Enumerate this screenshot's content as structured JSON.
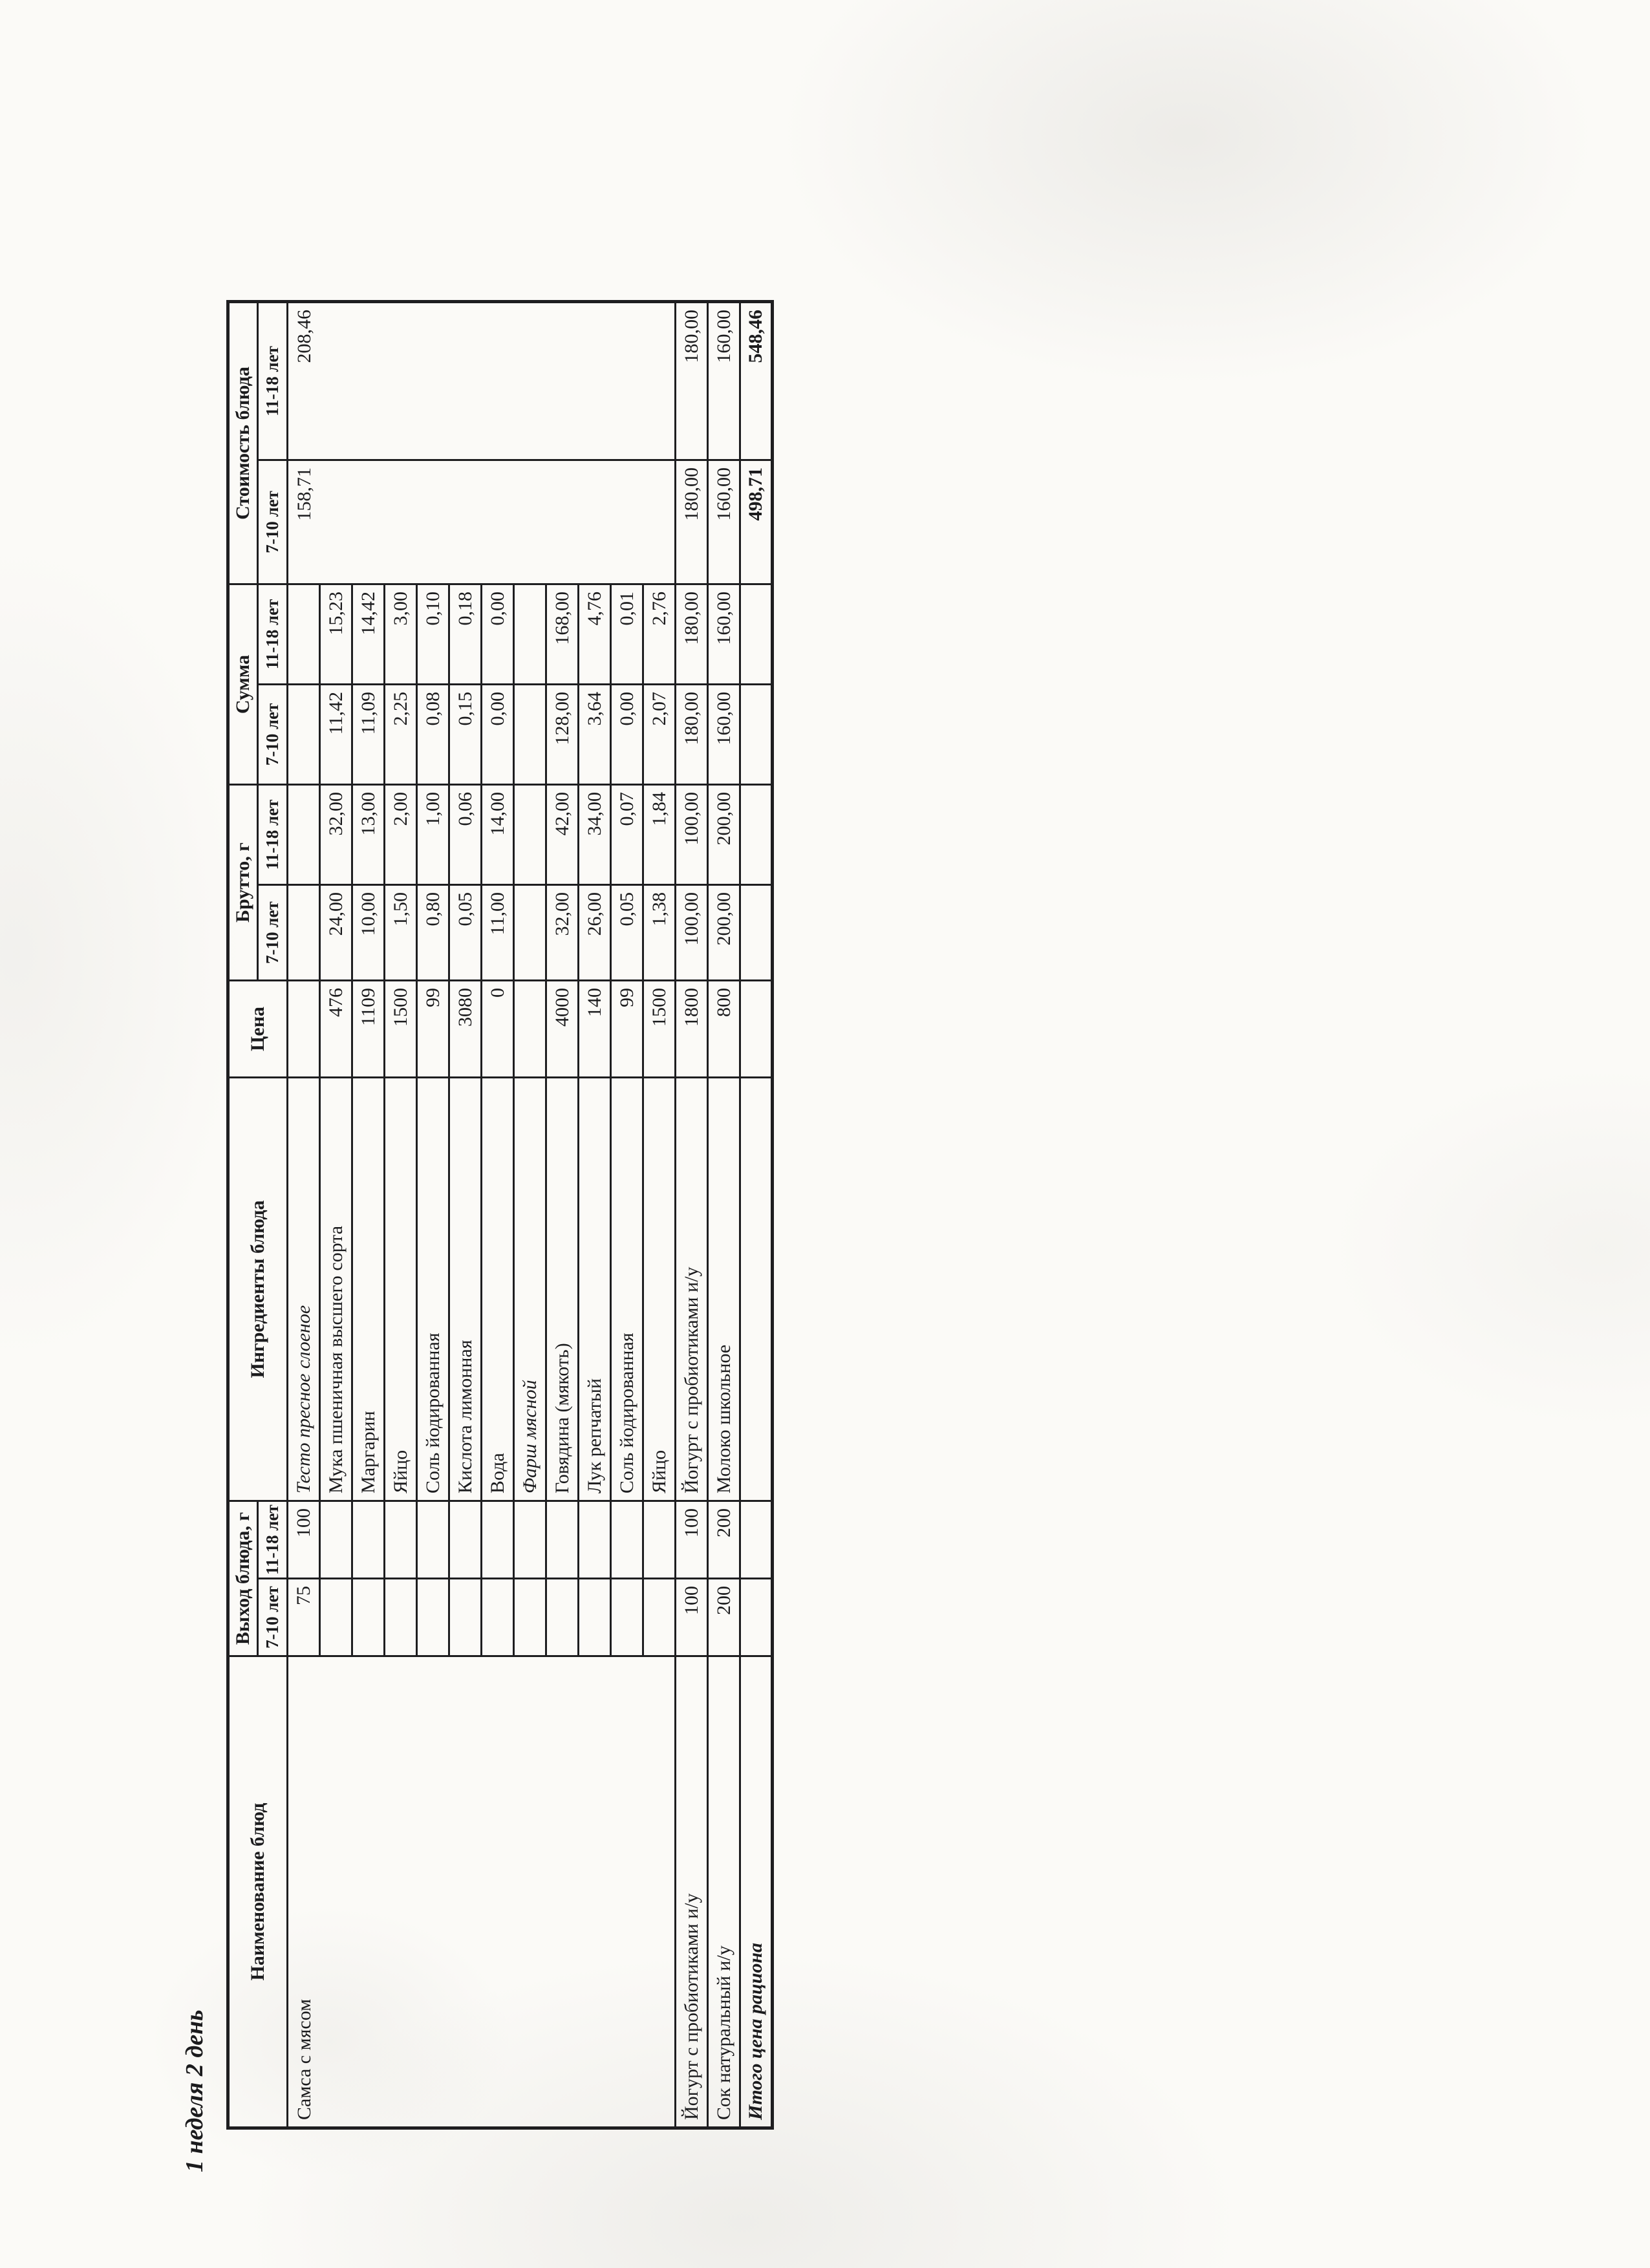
{
  "document": {
    "title": "1 неделя 2 день",
    "paper_color": "#fbfaf7",
    "ink_color": "#1b1b1d"
  },
  "table": {
    "column_headers": {
      "name": "Наименование блюд",
      "yield": "Выход блюда, г",
      "ingredients": "Ингредиенты блюда",
      "price": "Цена",
      "gross": "Брутто, г",
      "sum": "Сумма",
      "cost": "Стоимость блюда",
      "age_7_10": "7-10 лет",
      "age_11_18": "11-18 лет"
    },
    "body": [
      {
        "cells": [
          {
            "v": "Самса с мясом",
            "cls": "txt vtop",
            "rs": 12,
            "n": "dish-name-cell"
          },
          {
            "v": "75",
            "cls": "num"
          },
          {
            "v": "100",
            "cls": "num"
          },
          {
            "v": "Тесто пресное слоеное",
            "cls": "txt italic",
            "n": "ingredient-group-cell"
          },
          {
            "v": ""
          },
          {
            "v": ""
          },
          {
            "v": ""
          },
          {
            "v": ""
          },
          {
            "v": ""
          },
          {
            "v": "158,71",
            "cls": "num vtop",
            "rs": 12,
            "n": "dish-cost-cell"
          },
          {
            "v": "208,46",
            "cls": "num vtop",
            "rs": 12,
            "n": "dish-cost-cell"
          }
        ]
      },
      {
        "cells": [
          {
            "v": ""
          },
          {
            "v": ""
          },
          {
            "v": "Мука пшеничная высшего\nсорта",
            "cls": "txt",
            "n": "ingredient-cell"
          },
          {
            "v": "476",
            "cls": "num"
          },
          {
            "v": "24,00",
            "cls": "num"
          },
          {
            "v": "32,00",
            "cls": "num"
          },
          {
            "v": "11,42",
            "cls": "num"
          },
          {
            "v": "15,23",
            "cls": "num"
          }
        ]
      },
      {
        "cells": [
          {
            "v": ""
          },
          {
            "v": ""
          },
          {
            "v": "Маргарин",
            "cls": "txt",
            "n": "ingredient-cell"
          },
          {
            "v": "1109",
            "cls": "num"
          },
          {
            "v": "10,00",
            "cls": "num"
          },
          {
            "v": "13,00",
            "cls": "num"
          },
          {
            "v": "11,09",
            "cls": "num"
          },
          {
            "v": "14,42",
            "cls": "num"
          }
        ]
      },
      {
        "cells": [
          {
            "v": ""
          },
          {
            "v": ""
          },
          {
            "v": "Яйцо",
            "cls": "txt",
            "n": "ingredient-cell"
          },
          {
            "v": "1500",
            "cls": "num"
          },
          {
            "v": "1,50",
            "cls": "num"
          },
          {
            "v": "2,00",
            "cls": "num"
          },
          {
            "v": "2,25",
            "cls": "num"
          },
          {
            "v": "3,00",
            "cls": "num"
          }
        ]
      },
      {
        "cells": [
          {
            "v": ""
          },
          {
            "v": ""
          },
          {
            "v": "Соль йодированная",
            "cls": "txt",
            "n": "ingredient-cell"
          },
          {
            "v": "99",
            "cls": "num"
          },
          {
            "v": "0,80",
            "cls": "num"
          },
          {
            "v": "1,00",
            "cls": "num"
          },
          {
            "v": "0,08",
            "cls": "num"
          },
          {
            "v": "0,10",
            "cls": "num"
          }
        ]
      },
      {
        "cells": [
          {
            "v": ""
          },
          {
            "v": ""
          },
          {
            "v": "Кислота лимонная",
            "cls": "txt",
            "n": "ingredient-cell"
          },
          {
            "v": "3080",
            "cls": "num"
          },
          {
            "v": "0,05",
            "cls": "num"
          },
          {
            "v": "0,06",
            "cls": "num"
          },
          {
            "v": "0,15",
            "cls": "num"
          },
          {
            "v": "0,18",
            "cls": "num"
          }
        ]
      },
      {
        "cells": [
          {
            "v": ""
          },
          {
            "v": ""
          },
          {
            "v": "Вода",
            "cls": "txt",
            "n": "ingredient-cell"
          },
          {
            "v": "0",
            "cls": "num"
          },
          {
            "v": "11,00",
            "cls": "num"
          },
          {
            "v": "14,00",
            "cls": "num"
          },
          {
            "v": "0,00",
            "cls": "num"
          },
          {
            "v": "0,00",
            "cls": "num"
          }
        ]
      },
      {
        "cells": [
          {
            "v": ""
          },
          {
            "v": ""
          },
          {
            "v": "Фарш мясной",
            "cls": "txt italic",
            "n": "ingredient-group-cell"
          },
          {
            "v": ""
          },
          {
            "v": ""
          },
          {
            "v": ""
          },
          {
            "v": ""
          },
          {
            "v": ""
          }
        ]
      },
      {
        "cells": [
          {
            "v": ""
          },
          {
            "v": ""
          },
          {
            "v": "Говядина (мякоть)",
            "cls": "txt",
            "n": "ingredient-cell"
          },
          {
            "v": "4000",
            "cls": "num"
          },
          {
            "v": "32,00",
            "cls": "num"
          },
          {
            "v": "42,00",
            "cls": "num"
          },
          {
            "v": "128,00",
            "cls": "num"
          },
          {
            "v": "168,00",
            "cls": "num"
          }
        ]
      },
      {
        "cells": [
          {
            "v": ""
          },
          {
            "v": ""
          },
          {
            "v": "Лук репчатый",
            "cls": "txt",
            "n": "ingredient-cell"
          },
          {
            "v": "140",
            "cls": "num"
          },
          {
            "v": "26,00",
            "cls": "num"
          },
          {
            "v": "34,00",
            "cls": "num"
          },
          {
            "v": "3,64",
            "cls": "num"
          },
          {
            "v": "4,76",
            "cls": "num"
          }
        ]
      },
      {
        "cells": [
          {
            "v": ""
          },
          {
            "v": ""
          },
          {
            "v": "Соль йодированная",
            "cls": "txt",
            "n": "ingredient-cell"
          },
          {
            "v": "99",
            "cls": "num"
          },
          {
            "v": "0,05",
            "cls": "num"
          },
          {
            "v": "0,07",
            "cls": "num"
          },
          {
            "v": "0,00",
            "cls": "num"
          },
          {
            "v": "0,01",
            "cls": "num"
          }
        ]
      },
      {
        "cells": [
          {
            "v": ""
          },
          {
            "v": ""
          },
          {
            "v": "Яйцо",
            "cls": "txt",
            "n": "ingredient-cell"
          },
          {
            "v": "1500",
            "cls": "num"
          },
          {
            "v": "1,38",
            "cls": "num"
          },
          {
            "v": "1,84",
            "cls": "num"
          },
          {
            "v": "2,07",
            "cls": "num"
          },
          {
            "v": "2,76",
            "cls": "num"
          }
        ]
      },
      {
        "cells": [
          {
            "v": "Йогурт с пробиотиками и/у",
            "cls": "txt",
            "n": "dish-name-cell"
          },
          {
            "v": "100",
            "cls": "num"
          },
          {
            "v": "100",
            "cls": "num"
          },
          {
            "v": "Йогурт с пробиотиками и/у",
            "cls": "txt",
            "n": "ingredient-cell"
          },
          {
            "v": "1800",
            "cls": "num"
          },
          {
            "v": "100,00",
            "cls": "num"
          },
          {
            "v": "100,00",
            "cls": "num"
          },
          {
            "v": "180,00",
            "cls": "num"
          },
          {
            "v": "180,00",
            "cls": "num"
          },
          {
            "v": "180,00",
            "cls": "num",
            "n": "dish-cost-cell"
          },
          {
            "v": "180,00",
            "cls": "num",
            "n": "dish-cost-cell"
          }
        ]
      },
      {
        "cells": [
          {
            "v": "Сок натуральный и/у",
            "cls": "txt",
            "n": "dish-name-cell"
          },
          {
            "v": "200",
            "cls": "num"
          },
          {
            "v": "200",
            "cls": "num"
          },
          {
            "v": "Молоко школьное",
            "cls": "txt",
            "n": "ingredient-cell"
          },
          {
            "v": "800",
            "cls": "num"
          },
          {
            "v": "200,00",
            "cls": "num"
          },
          {
            "v": "200,00",
            "cls": "num"
          },
          {
            "v": "160,00",
            "cls": "num"
          },
          {
            "v": "160,00",
            "cls": "num"
          },
          {
            "v": "160,00",
            "cls": "num",
            "n": "dish-cost-cell"
          },
          {
            "v": "160,00",
            "cls": "num",
            "n": "dish-cost-cell"
          }
        ]
      },
      {
        "cells": [
          {
            "v": "Итого цена рациона",
            "cls": "txt bold italic",
            "n": "total-label-cell"
          },
          {
            "v": ""
          },
          {
            "v": ""
          },
          {
            "v": ""
          },
          {
            "v": ""
          },
          {
            "v": ""
          },
          {
            "v": ""
          },
          {
            "v": ""
          },
          {
            "v": ""
          },
          {
            "v": "498,71",
            "cls": "num bold",
            "n": "total-cost-cell"
          },
          {
            "v": "548,46",
            "cls": "num bold",
            "n": "total-cost-cell"
          }
        ]
      }
    ]
  }
}
